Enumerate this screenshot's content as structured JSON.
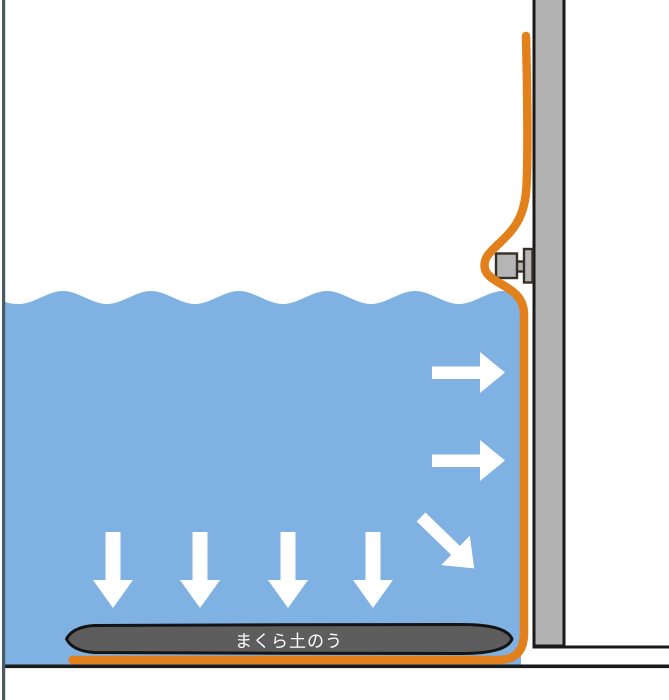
{
  "diagram": {
    "sandbag_label": "まくら土のう",
    "colors": {
      "background": "#FFFFFF",
      "water": "#7FB1E3",
      "sheet_orange": "#E2801C",
      "wall_gray": "#B3B3B3",
      "outline_black": "#1A1A1A",
      "sandbag_gray": "#5D5D5D",
      "sandbag_border": "#141414",
      "frame_line": "#4A5C63",
      "arrow_white": "#FFFFFF",
      "clamp_gray": "#B5B5B5",
      "clamp_border": "#352F26",
      "label_text": "#FFFFFF"
    }
  }
}
